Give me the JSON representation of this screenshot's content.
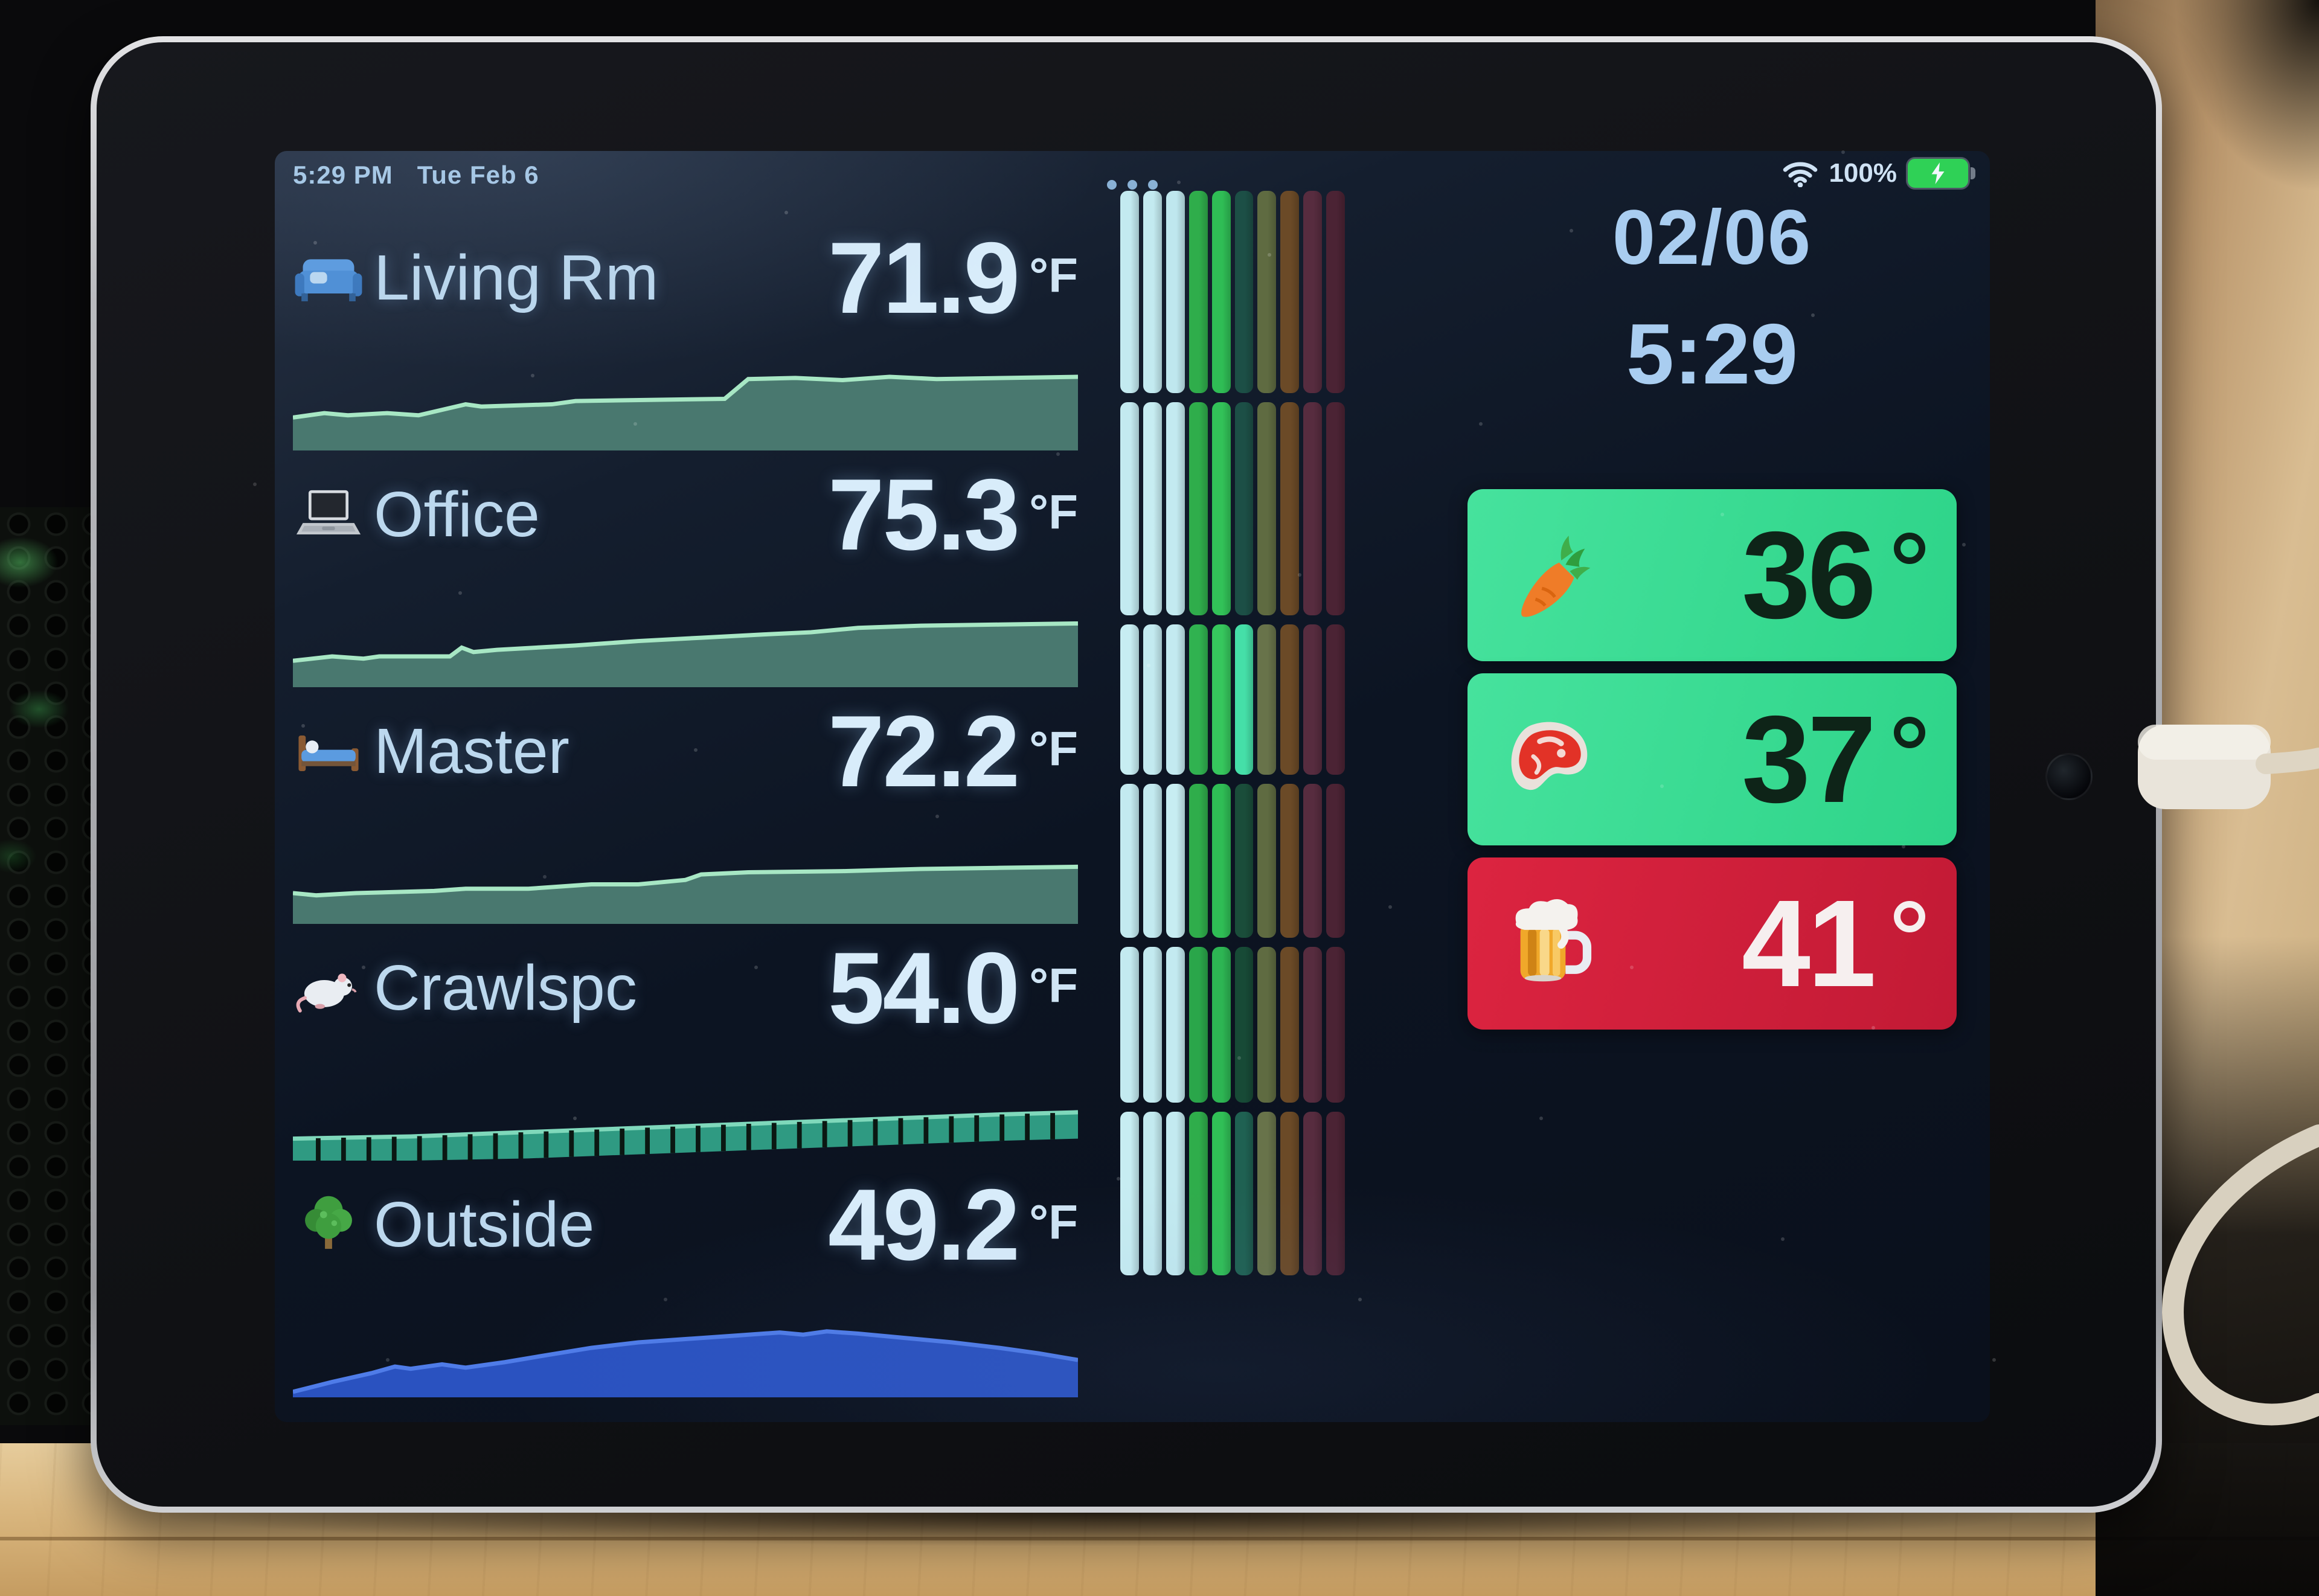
{
  "status_bar": {
    "time": "5:29 PM",
    "date": "Tue Feb 6",
    "battery_percent": "100%"
  },
  "clock": {
    "date": "02/06",
    "time": "5:29"
  },
  "rooms": [
    {
      "icon": "couch-icon",
      "name": "Living Rm",
      "temp": "71.9",
      "unit": "°F"
    },
    {
      "icon": "laptop-icon",
      "name": "Office",
      "temp": "75.3",
      "unit": "°F"
    },
    {
      "icon": "bed-icon",
      "name": "Master",
      "temp": "72.2",
      "unit": "°F"
    },
    {
      "icon": "rat-icon",
      "name": "Crawlspc",
      "temp": "54.0",
      "unit": "°F"
    },
    {
      "icon": "tree-icon",
      "name": "Outside",
      "temp": "49.2",
      "unit": "°F"
    }
  ],
  "tiles": [
    {
      "icon": "carrot-icon",
      "value": "36",
      "unit": "°",
      "bg": "linear-gradient(105deg,#46e29d 0%,#2ed489 100%)",
      "text_color": "#0e2418"
    },
    {
      "icon": "steak-icon",
      "value": "37",
      "unit": "°",
      "bg": "linear-gradient(105deg,#46e29d 0%,#2ed489 100%)",
      "text_color": "#0e2418"
    },
    {
      "icon": "beer-icon",
      "value": "41",
      "unit": "°",
      "bg": "linear-gradient(105deg,#dc2440 0%,#c21a35 100%)",
      "text_color": "#f6efef"
    }
  ],
  "chart_data": {
    "sparklines": [
      {
        "room": "Living Rm",
        "type": "area",
        "fill": "#49786f",
        "line": "#a7e7c4",
        "points": [
          [
            0,
            0.7
          ],
          [
            0.04,
            0.66
          ],
          [
            0.07,
            0.68
          ],
          [
            0.12,
            0.66
          ],
          [
            0.16,
            0.68
          ],
          [
            0.22,
            0.58
          ],
          [
            0.24,
            0.6
          ],
          [
            0.33,
            0.58
          ],
          [
            0.36,
            0.55
          ],
          [
            0.55,
            0.53
          ],
          [
            0.58,
            0.35
          ],
          [
            0.64,
            0.34
          ],
          [
            0.7,
            0.36
          ],
          [
            0.76,
            0.33
          ],
          [
            0.82,
            0.35
          ],
          [
            1,
            0.33
          ]
        ]
      },
      {
        "room": "Office",
        "type": "area",
        "fill": "#49786f",
        "line": "#a7e7c4",
        "points": [
          [
            0,
            0.76
          ],
          [
            0.05,
            0.72
          ],
          [
            0.09,
            0.74
          ],
          [
            0.11,
            0.72
          ],
          [
            0.2,
            0.72
          ],
          [
            0.215,
            0.64
          ],
          [
            0.23,
            0.68
          ],
          [
            0.26,
            0.66
          ],
          [
            0.36,
            0.62
          ],
          [
            0.44,
            0.58
          ],
          [
            0.52,
            0.55
          ],
          [
            0.6,
            0.52
          ],
          [
            0.66,
            0.5
          ],
          [
            0.72,
            0.46
          ],
          [
            0.8,
            0.44
          ],
          [
            0.9,
            0.43
          ],
          [
            1,
            0.42
          ]
        ]
      },
      {
        "room": "Master",
        "type": "area",
        "fill": "#49786f",
        "line": "#a7e7c4",
        "points": [
          [
            0,
            0.72
          ],
          [
            0.03,
            0.74
          ],
          [
            0.08,
            0.72
          ],
          [
            0.18,
            0.7
          ],
          [
            0.22,
            0.68
          ],
          [
            0.3,
            0.68
          ],
          [
            0.34,
            0.66
          ],
          [
            0.38,
            0.64
          ],
          [
            0.44,
            0.64
          ],
          [
            0.5,
            0.6
          ],
          [
            0.52,
            0.55
          ],
          [
            0.58,
            0.53
          ],
          [
            0.7,
            0.52
          ],
          [
            0.8,
            0.5
          ],
          [
            0.9,
            0.49
          ],
          [
            1,
            0.48
          ]
        ]
      },
      {
        "room": "Crawlspc",
        "type": "band",
        "fill": "#2f9a82",
        "line": "#7fd8bb",
        "thickness": 0.24,
        "ticks": 30,
        "points": [
          [
            0,
            0.8
          ],
          [
            0.15,
            0.78
          ],
          [
            0.3,
            0.74
          ],
          [
            0.45,
            0.7
          ],
          [
            0.6,
            0.66
          ],
          [
            0.75,
            0.62
          ],
          [
            0.9,
            0.58
          ],
          [
            1,
            0.56
          ]
        ]
      },
      {
        "room": "Outside",
        "type": "area",
        "fill": "#2a52c0",
        "line": "#4f7ce8",
        "points": [
          [
            0,
            0.95
          ],
          [
            0.05,
            0.86
          ],
          [
            0.1,
            0.78
          ],
          [
            0.13,
            0.72
          ],
          [
            0.15,
            0.74
          ],
          [
            0.19,
            0.7
          ],
          [
            0.22,
            0.73
          ],
          [
            0.27,
            0.68
          ],
          [
            0.32,
            0.62
          ],
          [
            0.38,
            0.55
          ],
          [
            0.44,
            0.5
          ],
          [
            0.5,
            0.47
          ],
          [
            0.56,
            0.44
          ],
          [
            0.62,
            0.41
          ],
          [
            0.65,
            0.43
          ],
          [
            0.68,
            0.4
          ],
          [
            0.72,
            0.42
          ],
          [
            0.78,
            0.46
          ],
          [
            0.84,
            0.5
          ],
          [
            0.9,
            0.55
          ],
          [
            0.95,
            0.6
          ],
          [
            1,
            0.66
          ]
        ]
      }
    ],
    "strip": {
      "type": "heatmap",
      "orientation": "vertical",
      "columns": 10,
      "block_heights": [
        335,
        353,
        249,
        255,
        258,
        271
      ],
      "colors": [
        [
          "#c3eaf0",
          "#c3eaf0",
          "#bfe7ee",
          "#2fad4b",
          "#2fbd55",
          "#1c4f46",
          "#5f6b41",
          "#6b4a27",
          "#572c3f",
          "#4b2334"
        ],
        [
          "#c3eaf0",
          "#c7edf2",
          "#c3eaf0",
          "#2fad4b",
          "#32c258",
          "#1c4f46",
          "#5f6b41",
          "#6b4a27",
          "#572c3f",
          "#4b2334"
        ],
        [
          "#c7edf2",
          "#c3eaf0",
          "#c3eaf0",
          "#30b250",
          "#36c75d",
          "#45dfa8",
          "#68734a",
          "#6b4a27",
          "#572c3f",
          "#4b2334"
        ],
        [
          "#c3eaf0",
          "#c3eaf0",
          "#c7edf2",
          "#2fad4b",
          "#2fbd55",
          "#1a4d3a",
          "#5f6b41",
          "#6b4a27",
          "#572c3f",
          "#4b2334"
        ],
        [
          "#c3eaf0",
          "#c3eaf0",
          "#c3eaf0",
          "#2aa64a",
          "#2db553",
          "#174a36",
          "#5f6b41",
          "#6b4a27",
          "#572c3f",
          "#4b2334"
        ],
        [
          "#c7edf2",
          "#c3eaf0",
          "#c3eaf0",
          "#2fad4b",
          "#30bf56",
          "#1f6152",
          "#68734a",
          "#6b4a27",
          "#572c3f",
          "#4b2334"
        ]
      ]
    }
  }
}
